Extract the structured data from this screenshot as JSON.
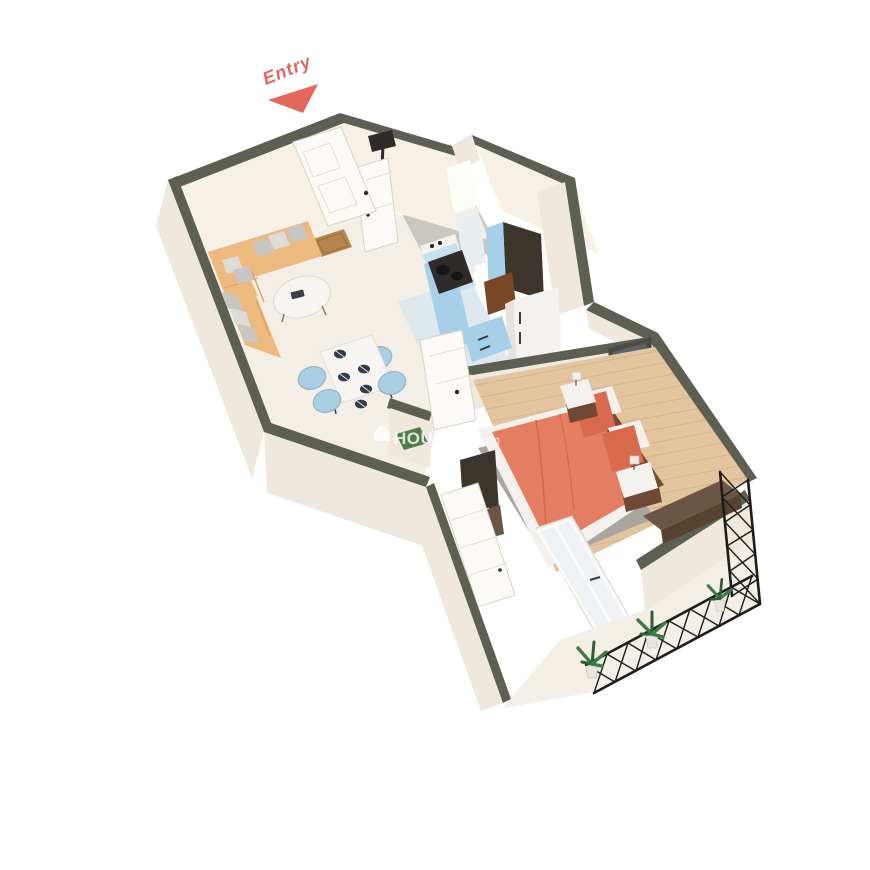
{
  "entry": {
    "label": "Entry"
  },
  "watermark": {
    "icon": "house-icon",
    "brand": "HOUSING",
    "suffix": ".com"
  },
  "palette": {
    "accent_coral": "#e2685b",
    "wall_top": "#5d5f53",
    "wall_face": "#efe8de",
    "wall_face_light": "#f6f0e7",
    "wall_face_shadow": "#e6ded2",
    "floor_tile": "#f3eee6",
    "floor_wood": "#e2c59e",
    "floor_wood_line": "#cfae80",
    "floor_kitchen": "#dfe8ec",
    "floor_bath": "#c9c7c1",
    "sofa_tan": "#edba7e",
    "sofa_shadow": "#daa263",
    "pillow_gray": "#c7c6c3",
    "table_white": "#f7f5f1",
    "chair_blue": "#a9cfe2",
    "cabinet_blue": "#a6cfe8",
    "cabinet_blue_light": "#c5e1f2",
    "unit_dark": "#3c352e",
    "counter_brown": "#774726",
    "appliance_white": "#f4f2ee",
    "stove_dark": "#2f2b28",
    "bed_coral": "#e57d60",
    "bed_coral_dark": "#d96a4e",
    "sheet_white": "#f3f1ed",
    "headboard_brown": "#7a4a36",
    "rug_gray": "#a9a6a0",
    "nightstand_brown": "#6e4936",
    "art_frame": "#4e4a44",
    "art_fill": "#5f646a",
    "wood_dark": "#6b5544",
    "door_white": "#fbfaf7",
    "railing_black": "#1d1d1b",
    "plant_green": "#3d7c46",
    "plant_green_dark": "#2d5f36",
    "pot_white": "#eae6de",
    "mat_brown": "#b5854e",
    "mat_green": "#4e7d4a",
    "watermark_white": "#ffffff"
  }
}
